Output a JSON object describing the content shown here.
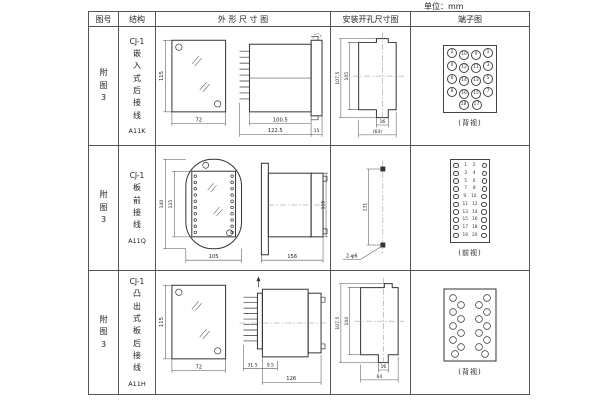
{
  "page": {
    "unit_label": "单位：mm"
  },
  "header": {
    "fig_no": "图号",
    "structure": "结构",
    "outline": "外 形 尺 寸 图",
    "mounting": "安装开孔尺寸图",
    "terminal": "端子图"
  },
  "rows": [
    {
      "fig_no": "附\n图\n3",
      "model": "CJ-1",
      "type": "嵌\n入\n式\n后\n接\n线",
      "code": "A11K",
      "dims": {
        "front_h": "115",
        "front_w": "72",
        "body_len": "100.5",
        "total_len": "122.5",
        "flange_w": "15"
      },
      "mount": {
        "h_outer": "107.5",
        "h_inner": "105",
        "w_slot": "16",
        "w_total": "(64)"
      },
      "terminal": {
        "label": "(背视)",
        "t": [
          [
            "2",
            "10",
            "9",
            "1"
          ],
          [
            "4",
            "12",
            "11",
            "3"
          ],
          [
            "6",
            "14",
            "13",
            "5"
          ],
          [
            "8",
            "16",
            "15",
            "7"
          ],
          [
            "18",
            "17"
          ]
        ]
      }
    },
    {
      "fig_no": "附\n图\n3",
      "model": "CJ-1",
      "type": "板\n前\n接\n线",
      "code": "A11Q",
      "dims": {
        "front_h_outer": "140",
        "front_h_inner": "125",
        "front_w": "105",
        "side_len": "156",
        "side_h": "115"
      },
      "mount": {
        "hole_spacing": "131",
        "hole_label": "2-φ6"
      },
      "terminal": {
        "label": "(前视)",
        "left": [
          "1",
          "3",
          "5",
          "7",
          "9",
          "11",
          "13",
          "15",
          "17",
          "19"
        ],
        "right": [
          "2",
          "4",
          "6",
          "8",
          "10",
          "12",
          "14",
          "16",
          "18",
          "20"
        ]
      }
    },
    {
      "fig_no": "附\n图\n3",
      "model": "CJ-1",
      "type": "凸\n出\n式\n板\n后\n接\n线",
      "code": "A11H",
      "dims": {
        "front_h": "115",
        "front_w": "72",
        "pin_len": "31.5",
        "step": "9.5",
        "body_len": "126"
      },
      "mount": {
        "h_outer": "107.5",
        "h_inner": "104",
        "w_slot": "16",
        "w_total": "64"
      },
      "terminal": {
        "label": "(背视)"
      }
    }
  ]
}
